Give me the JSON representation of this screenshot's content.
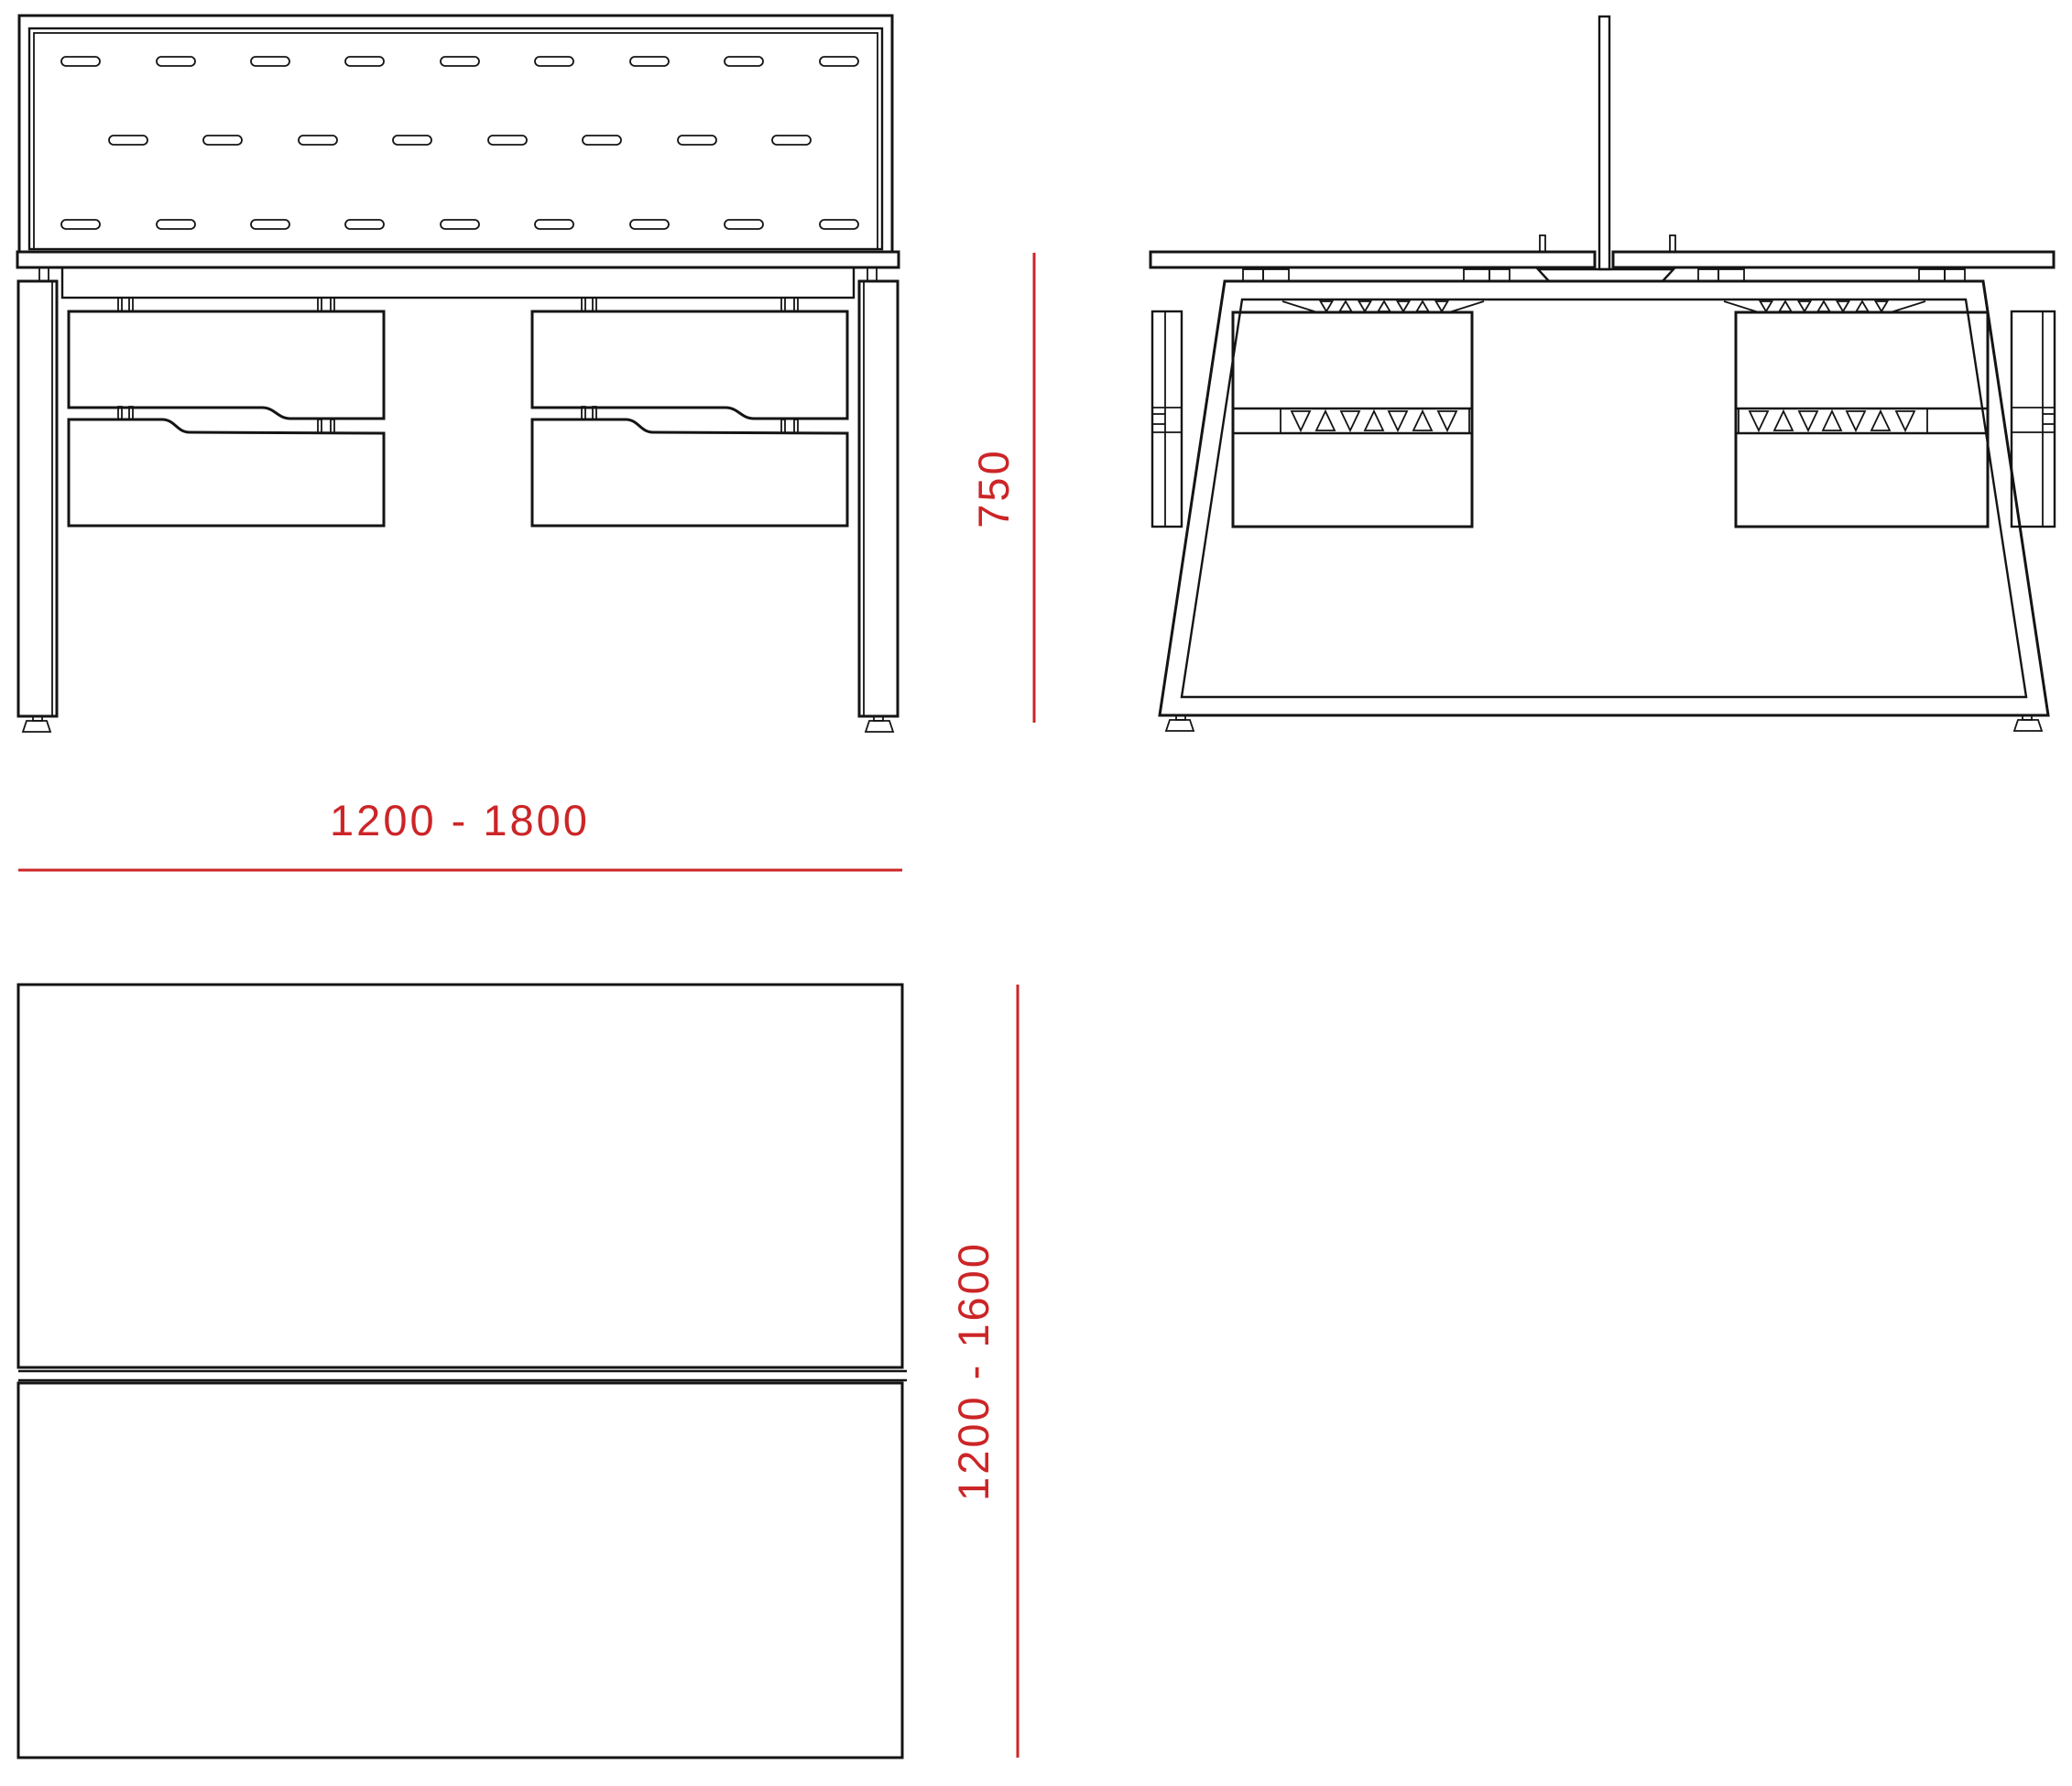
{
  "drawing": {
    "dimensions": {
      "height_label": "750",
      "width_label": "1200 - 1800",
      "depth_label": "1200 - 1600"
    },
    "colors": {
      "dimension_red": "#CC2527",
      "line_black": "#141414",
      "background": "#FFFFFF"
    }
  }
}
